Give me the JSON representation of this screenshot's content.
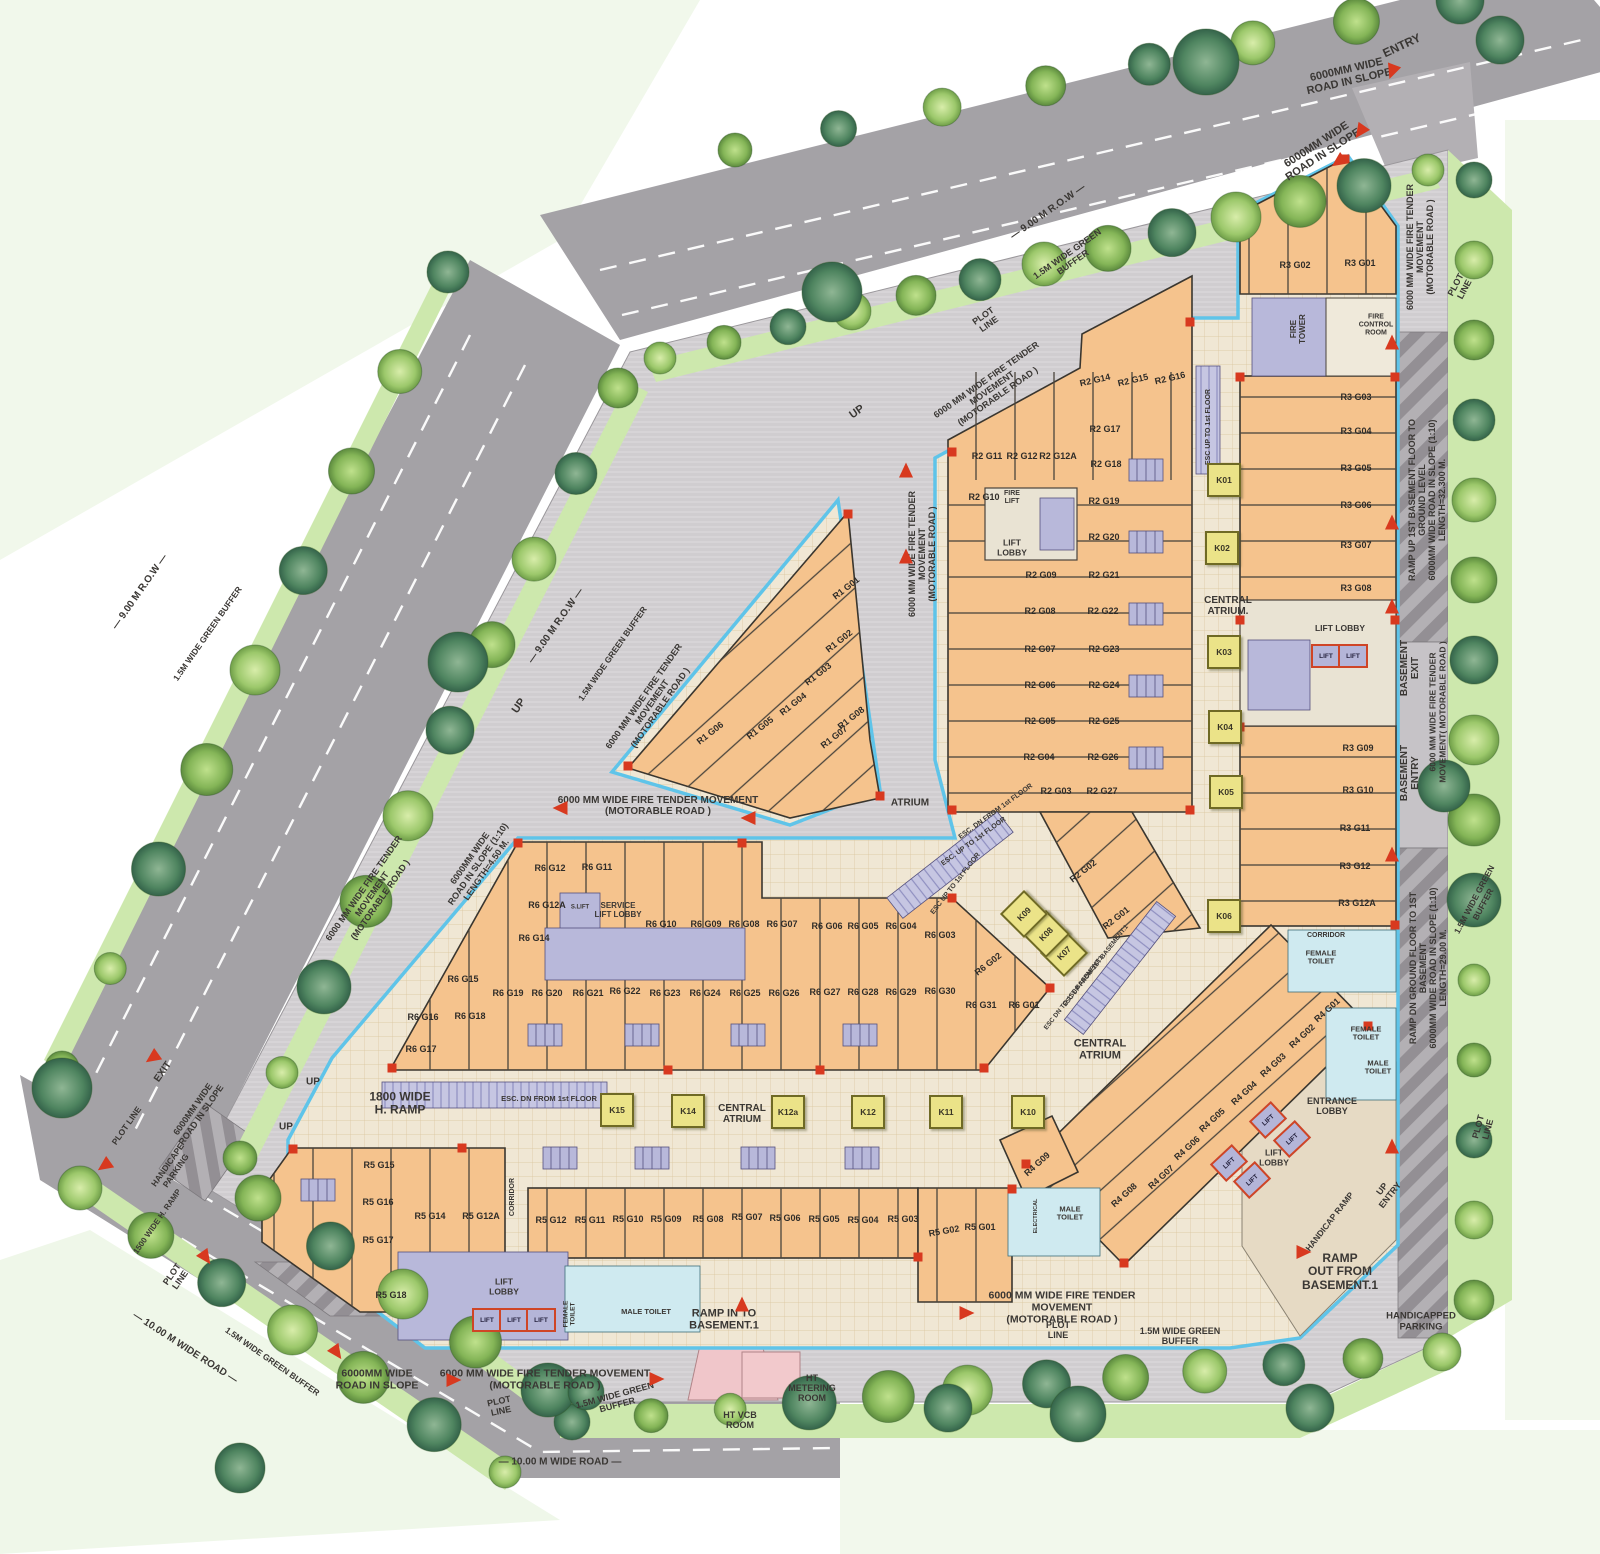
{
  "meta": {
    "plan_type": "ground floor site plan",
    "width": 1600,
    "height": 1554
  },
  "colors": {
    "unit_fill": "#f5c38d",
    "kiosk_fill": "#ebe388",
    "core_fill": "#b8b8da",
    "road_fill": "#a4a2a6",
    "buffer_fill": "#cde8ad",
    "edge_blue": "#5fc4e9",
    "accent_red": "#d8391f",
    "text_dark": "#3a3734",
    "atrium_floor": "#f0e7d4"
  },
  "labels": [
    [
      "entry",
      "ENTRY",
      1402,
      46,
      -25,
      12
    ],
    [
      "road-slope-tr-1",
      "6000MM WIDE\nROAD IN SLOPE",
      1348,
      76,
      -13,
      11
    ],
    [
      "road-slope-tr-2",
      "6000MM WIDE\nROAD IN SLOPE",
      1320,
      150,
      -33,
      11
    ],
    [
      "fire-tender-right-top",
      "6000 MM WIDE FIRE TENDER\nMOVEMENT\n(MOTORABLE ROAD )",
      1420,
      247,
      -90,
      9
    ],
    [
      "plot-line-tr",
      "PLOT\nLINE",
      1460,
      287,
      -62,
      9
    ],
    [
      "ramp-up-right",
      "RAMP UP 1ST BASEMENT FLOOR TO GROUND LEVEL\n6000MM WIDE  ROAD IN SLOPE (1:10)\nLENGTH=32.300 M.",
      1427,
      500,
      -90,
      9
    ],
    [
      "basement-exit",
      "BASEMENT\nEXIT",
      1410,
      668,
      -90,
      10
    ],
    [
      "fire-tender-right-mid",
      "6000 MM WIDE FIRE TENDER\nMOVEMENT( MOTORABLE ROAD )",
      1438,
      712,
      -90,
      8.5
    ],
    [
      "basement-entry",
      "BASEMENT\nENTRY",
      1410,
      773,
      -90,
      10
    ],
    [
      "ramp-dn-right",
      "RAMP DN GROUND FLOOR TO 1ST BASEMENT\n6000MM WIDE  ROAD IN SLOPE (1:10)\nLENGTH=29.00 M.",
      1428,
      968,
      -90,
      9
    ],
    [
      "green-buffer-right",
      "1.5M WIDE GREEN\nBUFFER",
      1479,
      902,
      -62,
      8.5
    ],
    [
      "plot-line-right",
      "PLOT\nLINE",
      1483,
      1128,
      -75,
      9
    ],
    [
      "plot-line-top",
      "PLOT\nLINE",
      986,
      320,
      -35,
      9
    ],
    [
      "green-buffer-top",
      "1.5M WIDE GREEN\nBUFFER",
      1070,
      258,
      -35,
      9
    ],
    [
      "row-top",
      "— 9.00 M R.O.W —",
      1048,
      212,
      -35,
      10
    ],
    [
      "up-top",
      "UP",
      857,
      412,
      -35,
      11
    ],
    [
      "fire-tender-top",
      "6000 MM WIDE FIRE TENDER\nMOVEMENT\n(MOTORABLE ROAD )",
      992,
      388,
      -35,
      9
    ],
    [
      "row-left-1",
      "— 9.00 M R.O.W —",
      556,
      626,
      -55,
      10
    ],
    [
      "green-buffer-left-1",
      "1.5M WIDE GREEN BUFFER",
      613,
      654,
      -55,
      8.5
    ],
    [
      "fire-tender-left-1",
      "6000 MM WIDE FIRE TENDER\nMOVEMENT\n(MOTORABLE ROAD )",
      652,
      702,
      -55,
      9
    ],
    [
      "up-left-1",
      "UP",
      519,
      706,
      -55,
      11
    ],
    [
      "row-left-2",
      "— 9.00 M R.O.W —",
      140,
      592,
      -55,
      10
    ],
    [
      "green-buffer-left-2",
      "1.5M WIDE GREEN BUFFER",
      208,
      634,
      -55,
      8.5
    ],
    [
      "fire-tender-left-2",
      "6000 MM WIDE FIRE TENDER\nMOVEMENT\n(MOTORABLE ROAD )",
      372,
      894,
      -55,
      9
    ],
    [
      "road-slope-left",
      "6000MM WIDE\nROAD IN SLOPE (1:10)\nLENGTH=4.50 M.",
      478,
      864,
      -55,
      9
    ],
    [
      "exit-left",
      "EXIT",
      163,
      1072,
      -55,
      10
    ],
    [
      "road-slope-left-2",
      "6000MM WIDE\nROAD IN SLOPE",
      197,
      1112,
      -55,
      9
    ],
    [
      "plot-line-left-1",
      "PLOT LINE",
      127,
      1126,
      -55,
      8.5
    ],
    [
      "handicap-parking-left",
      "HANDICAPE\nPARKING",
      172,
      1168,
      -55,
      8.5
    ],
    [
      "h-ramp-left",
      "1500 WIDE H. RAMP",
      158,
      1222,
      -55,
      8
    ],
    [
      "plot-line-left-2",
      "PLOT\nLINE",
      176,
      1277,
      -55,
      9
    ],
    [
      "wide-road-bl",
      "— 10.00 M WIDE ROAD —",
      185,
      1348,
      33,
      10
    ],
    [
      "green-buffer-bl",
      "1.5M WIDE GREEN BUFFER",
      272,
      1362,
      35,
      8.5
    ],
    [
      "road-slope-bottom",
      "6000MM WIDE\nROAD IN SLOPE",
      377,
      1380,
      0,
      10.5
    ],
    [
      "fire-tender-bottom-1",
      "6000 MM WIDE FIRE TENDER MOVEMENT\n(MOTORABLE ROAD )",
      545,
      1380,
      0,
      10.5
    ],
    [
      "fire-tender-bottom-2",
      "6000 MM WIDE FIRE TENDER\nMOVEMENT\n(MOTORABLE ROAD )",
      1062,
      1308,
      0,
      10.5
    ],
    [
      "plot-line-bottom-1",
      "PLOT\nLINE",
      500,
      1406,
      -12,
      9
    ],
    [
      "green-buffer-bottom-1",
      "1.5M WIDE GREEN\nBUFFER",
      616,
      1400,
      -15,
      9
    ],
    [
      "ht-vcb",
      "HT VCB\nROOM",
      740,
      1420,
      0,
      9
    ],
    [
      "ht-metering",
      "HT\nMETERING\nROOM",
      812,
      1388,
      0,
      9
    ],
    [
      "wide-road-bottom",
      "— 10.00 M WIDE ROAD —",
      560,
      1462,
      0,
      10
    ],
    [
      "plot-line-bottom-2",
      "PLOT\nLINE",
      1058,
      1330,
      0,
      9
    ],
    [
      "green-buffer-bottom-2",
      "1.5M WIDE GREEN\nBUFFER",
      1180,
      1336,
      0,
      9
    ],
    [
      "handicapped-parking-br",
      "HANDICAPPED\nPARKING",
      1421,
      1322,
      0,
      9.5
    ],
    [
      "ramp-out",
      "RAMP\nOUT FROM\nBASEMENT.1",
      1340,
      1272,
      0,
      12
    ],
    [
      "handicap-ramp",
      "HANDICAP RAMP",
      1330,
      1222,
      -52,
      8.5
    ],
    [
      "up-entry",
      "UP\nENTRY",
      1386,
      1192,
      -52,
      9
    ],
    [
      "ramp-in",
      "RAMP IN TO\nBASEMENT.1",
      724,
      1320,
      0,
      11
    ],
    [
      "h-ramp-1800",
      "1800 WIDE\nH. RAMP",
      400,
      1104,
      0,
      12
    ],
    [
      "up-bl-1",
      "UP",
      313,
      1082,
      0,
      10
    ],
    [
      "up-bl-2",
      "UP",
      286,
      1127,
      0,
      10
    ],
    [
      "fire-tender-mid",
      "6000 MM WIDE FIRE TENDER MOVEMENT\n(MOTORABLE ROAD )",
      658,
      806,
      0,
      10
    ],
    [
      "atrium",
      "ATRIUM",
      910,
      803,
      0,
      10
    ],
    [
      "central-atrium-right",
      "CENTRAL\nATRIUM.",
      1228,
      606,
      0,
      10
    ],
    [
      "central-atrium-main",
      "CENTRAL\nATRIUM",
      1100,
      1050,
      0,
      11
    ],
    [
      "central-atrium-row",
      "CENTRAL\nATRIUM",
      742,
      1114,
      0,
      10
    ],
    [
      "fire-tender-center",
      "6000 MM WIDE FIRE TENDER\nMOVEMENT\n(MOTORABLE ROAD )",
      922,
      554,
      -90,
      9
    ],
    [
      "esc-up-col",
      "ESC UP TO 1st FLOOR",
      1209,
      427,
      -90,
      7
    ],
    [
      "esc-dn-row",
      "ESC. DN FROM 1st FLOOR",
      549,
      1099,
      0,
      7.5
    ],
    [
      "esc-dn-diag",
      "ESC. DN FROM 1st FLOOR",
      996,
      812,
      -36,
      7
    ],
    [
      "esc-up-diag",
      "ESC. UP TO 1st FLOOR",
      974,
      842,
      -36,
      7
    ],
    [
      "esc-up-diag2",
      "ESC UP TO 1st FLOOR",
      956,
      884,
      -52,
      7
    ],
    [
      "esc-up-bsmt",
      "ESC UP FROM 1ST BASEMENT.1",
      1096,
      966,
      -52,
      6.5
    ],
    [
      "esc-dn-bsmt",
      "ESC DN TO 1ST BASEMENT.1",
      1074,
      993,
      -52,
      6.5
    ],
    [
      "corridor-left",
      "CORRIDOR",
      513,
      1197,
      -90,
      7
    ],
    [
      "corridor-right",
      "CORRIDOR",
      1326,
      936,
      0,
      7
    ],
    [
      "lift-lobby-r2",
      "LIFT\nLOBBY",
      1012,
      548,
      0,
      8.5
    ],
    [
      "fire-lift-r2",
      "FIRE\nLIFT",
      1012,
      498,
      0,
      7
    ],
    [
      "lift-lobby-r3",
      "LIFT LOBBY",
      1340,
      629,
      0,
      8.5
    ],
    [
      "fire-tower",
      "FIRE\nTOWER",
      1299,
      329,
      -90,
      8
    ],
    [
      "fire-control-room",
      "FIRE\nCONTROL\nROOM",
      1376,
      325,
      0,
      7
    ],
    [
      "lift-lobby-r5",
      "LIFT\nLOBBY",
      504,
      1287,
      0,
      8.5
    ],
    [
      "female-toilet-r5",
      "FEMALE\nTOILET",
      570,
      1314,
      -90,
      6.5
    ],
    [
      "male-toilet-r5",
      "MALE TOILET",
      646,
      1312,
      0,
      7.5
    ],
    [
      "male-toilet-r4",
      "MALE\nTOILET",
      1070,
      1214,
      0,
      7.5
    ],
    [
      "female-toilet-r3",
      "FEMALE\nTOILET",
      1321,
      958,
      0,
      7.5
    ],
    [
      "female-toilet-r4",
      "FEMALE\nTOILET",
      1366,
      1034,
      0,
      7.5
    ],
    [
      "male-toilet-r4b",
      "MALE\nTOILET",
      1378,
      1068,
      0,
      7.5
    ],
    [
      "entrance-lobby",
      "ENTRANCE\nLOBBY",
      1332,
      1106,
      0,
      9
    ],
    [
      "lift-lobby-r4",
      "LIFT\nLOBBY",
      1274,
      1158,
      0,
      8.5
    ],
    [
      "service-lift-lobby",
      "SERVICE\nLIFT LOBBY",
      618,
      911,
      0,
      8
    ],
    [
      "s-lift",
      "S.LIFT",
      580,
      908,
      0,
      6
    ],
    [
      "electrical",
      "ELECTRICAL",
      1036,
      1216,
      -90,
      5.5
    ]
  ],
  "unit_labels": [
    [
      "R1 G01",
      846,
      588,
      -38
    ],
    [
      "R1 G02",
      839,
      641,
      -38
    ],
    [
      "R1 G03",
      818,
      674,
      -38
    ],
    [
      "R1 G04",
      793,
      704,
      -38
    ],
    [
      "R1 G05",
      760,
      728,
      -38
    ],
    [
      "R1 G06",
      710,
      733,
      -38
    ],
    [
      "R1 G07",
      834,
      737,
      -38
    ],
    [
      "R1 G08",
      851,
      718,
      -38
    ],
    [
      "R2 G11",
      987,
      456,
      0
    ],
    [
      "R2 G12",
      1022,
      456,
      0
    ],
    [
      "R2 G12A",
      1058,
      456,
      0
    ],
    [
      "R2 G10",
      984,
      497,
      0
    ],
    [
      "R2 G14",
      1095,
      380,
      -13
    ],
    [
      "R2 G15",
      1133,
      380,
      -13
    ],
    [
      "R2 G16",
      1170,
      378,
      -13
    ],
    [
      "R2 G17",
      1105,
      429,
      0
    ],
    [
      "R2 G18",
      1106,
      464,
      0
    ],
    [
      "R2 G19",
      1104,
      501,
      0
    ],
    [
      "R2 G20",
      1104,
      537,
      0
    ],
    [
      "R2 G21",
      1104,
      575,
      0
    ],
    [
      "R2 G22",
      1103,
      611,
      0
    ],
    [
      "R2 G23",
      1104,
      649,
      0
    ],
    [
      "R2 G24",
      1104,
      685,
      0
    ],
    [
      "R2 G25",
      1104,
      721,
      0
    ],
    [
      "R2 G26",
      1103,
      757,
      0
    ],
    [
      "R2 G27",
      1102,
      791,
      0
    ],
    [
      "R2 G09",
      1041,
      575,
      0
    ],
    [
      "R2 G08",
      1040,
      611,
      0
    ],
    [
      "R2 G07",
      1040,
      649,
      0
    ],
    [
      "R2 G06",
      1040,
      685,
      0
    ],
    [
      "R2 G05",
      1040,
      721,
      0
    ],
    [
      "R2 G04",
      1039,
      757,
      0
    ],
    [
      "R2 G03",
      1056,
      791,
      0
    ],
    [
      "R2 G02",
      1083,
      871,
      -38
    ],
    [
      "R2 G01",
      1116,
      918,
      -38
    ],
    [
      "R3 G02",
      1295,
      265,
      0
    ],
    [
      "R3 G01",
      1360,
      263,
      0
    ],
    [
      "R3 G03",
      1356,
      397,
      0
    ],
    [
      "R3 G04",
      1356,
      431,
      0
    ],
    [
      "R3 G05",
      1356,
      468,
      0
    ],
    [
      "R3 G06",
      1356,
      505,
      0
    ],
    [
      "R3 G07",
      1356,
      545,
      0
    ],
    [
      "R3 G08",
      1356,
      588,
      0
    ],
    [
      "R3 G09",
      1358,
      748,
      0
    ],
    [
      "R3 G10",
      1358,
      790,
      0
    ],
    [
      "R3 G11",
      1355,
      828,
      0
    ],
    [
      "R3 G12",
      1355,
      866,
      0
    ],
    [
      "R3 G12A",
      1357,
      903,
      0
    ],
    [
      "R4 G01",
      1327,
      1010,
      -42
    ],
    [
      "R4 G02",
      1302,
      1036,
      -42
    ],
    [
      "R4 G03",
      1273,
      1065,
      -42
    ],
    [
      "R4 G04",
      1244,
      1093,
      -42
    ],
    [
      "R4 G05",
      1212,
      1120,
      -42
    ],
    [
      "R4 G06",
      1187,
      1148,
      -42
    ],
    [
      "R4 G07",
      1161,
      1177,
      -42
    ],
    [
      "R4 G08",
      1124,
      1195,
      -42
    ],
    [
      "R4 G09",
      1037,
      1164,
      -42
    ],
    [
      "R5 G15",
      379,
      1165,
      0
    ],
    [
      "R5 G16",
      378,
      1202,
      0
    ],
    [
      "R5 G17",
      378,
      1240,
      0
    ],
    [
      "R5 G18",
      391,
      1295,
      0
    ],
    [
      "R5 G14",
      430,
      1216,
      0
    ],
    [
      "R5 G12A",
      481,
      1216,
      0
    ],
    [
      "R5 G12",
      551,
      1220,
      0
    ],
    [
      "R5 G11",
      590,
      1220,
      0
    ],
    [
      "R5 G10",
      628,
      1219,
      0
    ],
    [
      "R5 G09",
      666,
      1219,
      0
    ],
    [
      "R5 G08",
      708,
      1219,
      0
    ],
    [
      "R5 G07",
      747,
      1217,
      0
    ],
    [
      "R5 G06",
      785,
      1218,
      0
    ],
    [
      "R5 G05",
      824,
      1219,
      0
    ],
    [
      "R5 G04",
      863,
      1220,
      0
    ],
    [
      "R5 G03",
      903,
      1219,
      0
    ],
    [
      "R5 G02",
      944,
      1231,
      -10
    ],
    [
      "R5 G01",
      980,
      1227,
      0
    ],
    [
      "R6 G12",
      550,
      868,
      0
    ],
    [
      "R6 G11",
      597,
      867,
      0
    ],
    [
      "R6 G12A",
      547,
      905,
      0
    ],
    [
      "R6 G14",
      534,
      938,
      0
    ],
    [
      "R6 G15",
      463,
      979,
      0
    ],
    [
      "R6 G16",
      423,
      1017,
      0
    ],
    [
      "R6 G18",
      470,
      1016,
      0
    ],
    [
      "R6 G17",
      421,
      1049,
      0
    ],
    [
      "R6 G19",
      508,
      993,
      0
    ],
    [
      "R6 G20",
      547,
      993,
      0
    ],
    [
      "R6 G21",
      588,
      993,
      0
    ],
    [
      "R6 G22",
      625,
      991,
      0
    ],
    [
      "R6 G23",
      665,
      993,
      0
    ],
    [
      "R6 G24",
      705,
      993,
      0
    ],
    [
      "R6 G25",
      745,
      993,
      0
    ],
    [
      "R6 G26",
      784,
      993,
      0
    ],
    [
      "R6 G10",
      661,
      924,
      0
    ],
    [
      "R6 G09",
      706,
      924,
      0
    ],
    [
      "R6 G08",
      744,
      924,
      0
    ],
    [
      "R6 G07",
      782,
      924,
      0
    ],
    [
      "R6 G06",
      827,
      926,
      0
    ],
    [
      "R6 G05",
      863,
      926,
      0
    ],
    [
      "R6 G04",
      901,
      926,
      0
    ],
    [
      "R6 G03",
      940,
      935,
      0
    ],
    [
      "R6 G02",
      988,
      964,
      -38
    ],
    [
      "R6 G27",
      825,
      992,
      0
    ],
    [
      "R6 G28",
      863,
      992,
      0
    ],
    [
      "R6 G29",
      901,
      992,
      0
    ],
    [
      "R6 G30",
      940,
      991,
      0
    ],
    [
      "R6 G31",
      981,
      1005,
      0
    ],
    [
      "R6 G01",
      1024,
      1005,
      0
    ]
  ],
  "kiosks": [
    [
      "K01",
      1224,
      480,
      0
    ],
    [
      "K02",
      1222,
      548,
      0
    ],
    [
      "K03",
      1224,
      652,
      0
    ],
    [
      "K04",
      1225,
      727,
      0
    ],
    [
      "K05",
      1226,
      792,
      0
    ],
    [
      "K06",
      1224,
      916,
      0
    ],
    [
      "K07",
      1064,
      953,
      -45
    ],
    [
      "K08",
      1046,
      934,
      -45
    ],
    [
      "K09",
      1024,
      914,
      -45
    ],
    [
      "K10",
      1028,
      1112,
      0
    ],
    [
      "K11",
      946,
      1112,
      0
    ],
    [
      "K12",
      868,
      1112,
      0
    ],
    [
      "K12a",
      788,
      1112,
      0
    ],
    [
      "K14",
      688,
      1111,
      0
    ],
    [
      "K15",
      617,
      1110,
      0
    ]
  ],
  "lifts": [
    [
      1326,
      656,
      0
    ],
    [
      1353,
      656,
      0
    ],
    [
      487,
      1320,
      0
    ],
    [
      514,
      1320,
      0
    ],
    [
      541,
      1320,
      0
    ],
    [
      1268,
      1120,
      -43
    ],
    [
      1292,
      1139,
      -43
    ],
    [
      1229,
      1163,
      -43
    ],
    [
      1252,
      1180,
      -43
    ]
  ],
  "arrows": [
    [
      1392,
      72,
      200
    ],
    [
      1360,
      132,
      215
    ],
    [
      1338,
      162,
      235
    ],
    [
      1392,
      342,
      0
    ],
    [
      1392,
      522,
      0
    ],
    [
      1392,
      606,
      0
    ],
    [
      1392,
      854,
      0
    ],
    [
      1392,
      1146,
      0
    ],
    [
      1304,
      1252,
      90
    ],
    [
      742,
      1304,
      0
    ],
    [
      337,
      1353,
      145
    ],
    [
      454,
      1380,
      90
    ],
    [
      657,
      1379,
      90
    ],
    [
      967,
      1313,
      90
    ],
    [
      152,
      1058,
      235
    ],
    [
      104,
      1166,
      235
    ],
    [
      206,
      1258,
      145
    ],
    [
      560,
      808,
      270
    ],
    [
      748,
      818,
      270
    ],
    [
      906,
      470,
      0
    ],
    [
      906,
      556,
      0
    ]
  ]
}
